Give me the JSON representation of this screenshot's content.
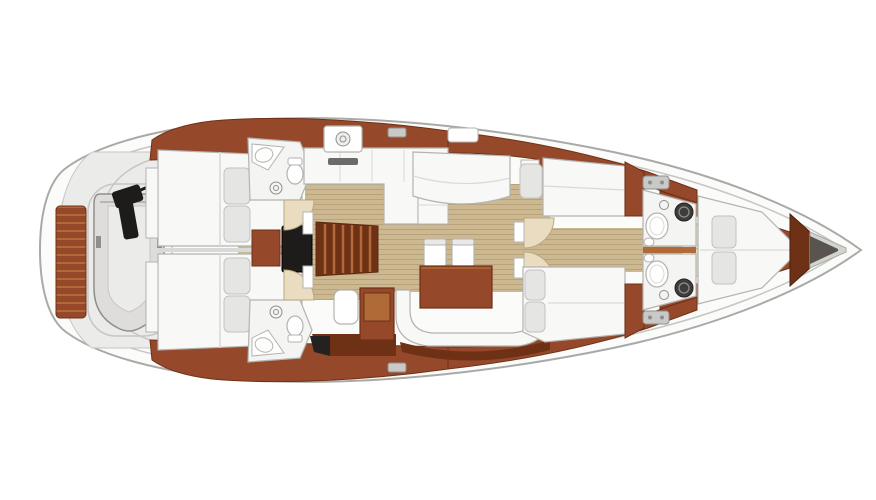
{
  "meta": {
    "title": "Sailing yacht interior deck layout plan, top-down view, bow pointing right",
    "view": "top-down-floor-plan"
  },
  "rooms": [
    "tender-garage-with-dinghy",
    "aft-cabin-port",
    "aft-cabin-starboard",
    "aft-head-port",
    "aft-head-starboard",
    "companionway-stairs",
    "galley",
    "salon-dinette",
    "chart-table-station",
    "port-settee",
    "mid-cabin-port",
    "mid-cabin-starboard",
    "forward-head-port",
    "forward-head-starboard",
    "forward-v-berth-cabin",
    "anchor-locker"
  ],
  "icons": [
    "dinghy-icon",
    "outboard-motor-icon",
    "toilet-icon",
    "sink-icon",
    "shower-drain-icon",
    "washer-port-icon",
    "stove-icon",
    "deck-hatch-icon",
    "cleat-icon",
    "door-swing-arc-icon",
    "pillow-icon",
    "stairs-icon"
  ],
  "colors": {
    "page_bg": "#ffffff",
    "hull_fill": "#fbfbf9",
    "hull_stroke": "#a9a9a7",
    "deck": "#ebebe9",
    "deck_line": "#c6c6c4",
    "wood": "#96492a",
    "wood_dark": "#6f3115",
    "wood_light": "#b06a38",
    "floor": "#ccb992",
    "floor_stripe": "#b9a27a",
    "furn_white": "#f8f8f6",
    "furn_stroke": "#b3b3b1",
    "bath_floor": "#f4f4f2",
    "pillow": "#e5e5e3",
    "pillow_stroke": "#c2c2c0",
    "dark_fixture": "#1e1c1a",
    "steel": "#c9c9c7",
    "steel_dark": "#8f8f8d",
    "dinghy": "#dedddb",
    "dinghy_inner": "#ebebe9",
    "locker": "#d3d3cf",
    "locker_dark": "#5a544e",
    "arc_fill": "#e9dcc1",
    "arc_stroke": "#bda87e",
    "seam": "#d9d9d7",
    "stove": "#6b6b69"
  }
}
